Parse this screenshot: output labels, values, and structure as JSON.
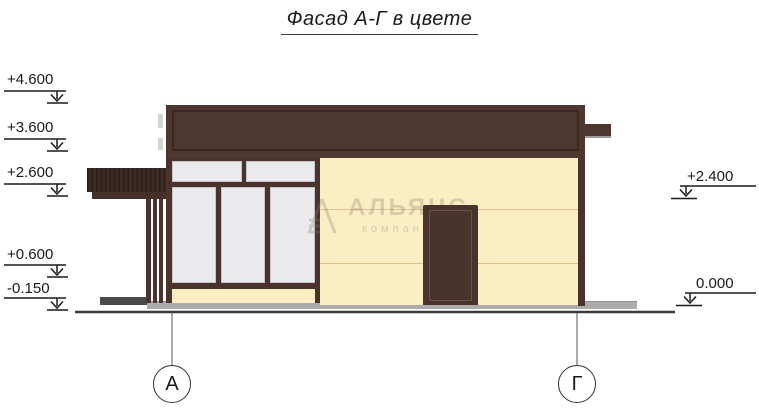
{
  "title": "Фасад А-Г в цвете",
  "levels_left": [
    {
      "label": "+4.600"
    },
    {
      "label": "+3.600"
    },
    {
      "label": "+2.600"
    },
    {
      "label": "+0.600"
    },
    {
      "label": "-0.150"
    }
  ],
  "levels_right": [
    {
      "label": "+2.400"
    },
    {
      "label": "0.000"
    }
  ],
  "axes": [
    {
      "label": "А"
    },
    {
      "label": "Г"
    }
  ],
  "watermark": {
    "name": "АЛЬЯНС",
    "subtitle": "компания"
  },
  "colors": {
    "roof": "#4e372e",
    "roofline": "#3a2822",
    "frame": "#4a332c",
    "slats": "#3e2b23",
    "slatline": "#2c1f1a",
    "wall": "#fbeec3",
    "seam": "#dcc28e",
    "glass": "#eaeaec",
    "glassedge": "#c7c5ca",
    "doorinner": "#6e5041",
    "pavement": "#acacac",
    "step": "#4a4a4a",
    "ink": "#1a1a1a",
    "ground": "#3a3a3a",
    "pipeshadow": "#9c9c9c",
    "notch": "#d8d3d0",
    "watermark": "#8d7b6b"
  }
}
